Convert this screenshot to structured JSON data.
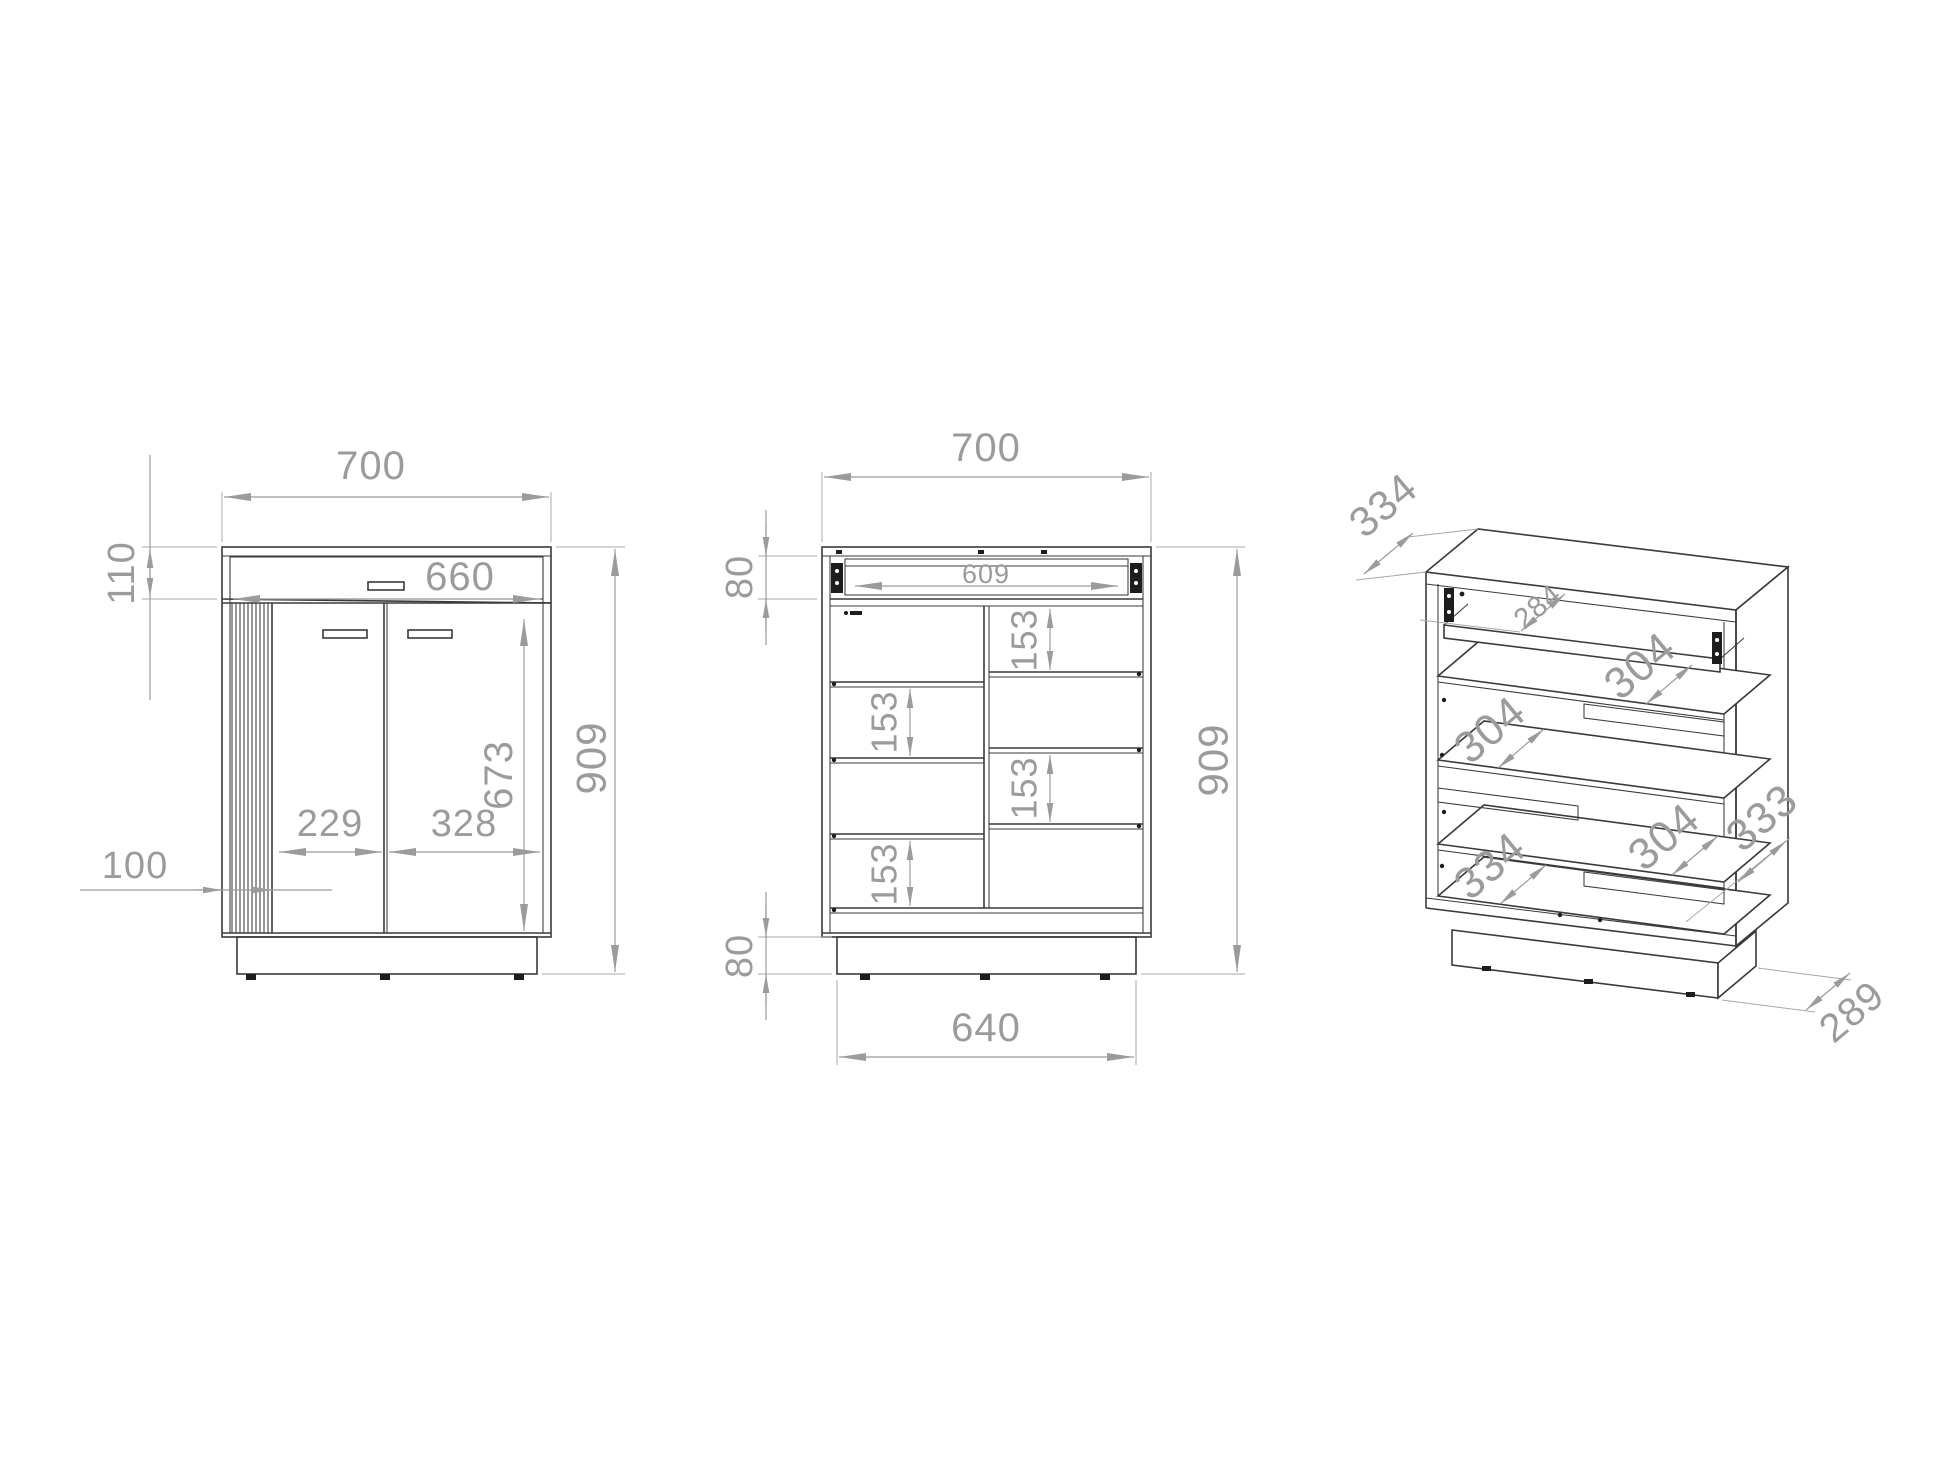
{
  "document": {
    "type": "furniture-technical-drawing",
    "background": "#ffffff",
    "line_color": "#3a3a3a",
    "dim_color": "#9b9b9b"
  },
  "views": {
    "front_closed": {
      "label": "front view closed",
      "dims": {
        "overall_width": "700",
        "drawer_front_height": "110",
        "inner_width": "660",
        "door_height": "673",
        "overall_height": "909",
        "left_door_width": "229",
        "right_door_width": "328",
        "slat_panel_width": "100"
      }
    },
    "front_open": {
      "label": "front view open carcass",
      "dims": {
        "overall_width": "700",
        "drawer_box_height": "80",
        "drawer_inner_width": "609",
        "compartment_height_1": "153",
        "compartment_height_2": "153",
        "compartment_height_3": "153",
        "compartment_height_4": "153",
        "overall_height": "909",
        "plinth_height": "80",
        "plinth_width": "640"
      }
    },
    "perspective": {
      "label": "perspective view",
      "dims": {
        "top_depth": "334",
        "drawer_depth": "284",
        "shelf_depth_upper": "304",
        "shelf_depth_middle": "304",
        "shelf_depth_lower": "304",
        "bottom_depth": "334",
        "side_depth": "333",
        "plinth_depth": "289"
      }
    }
  }
}
